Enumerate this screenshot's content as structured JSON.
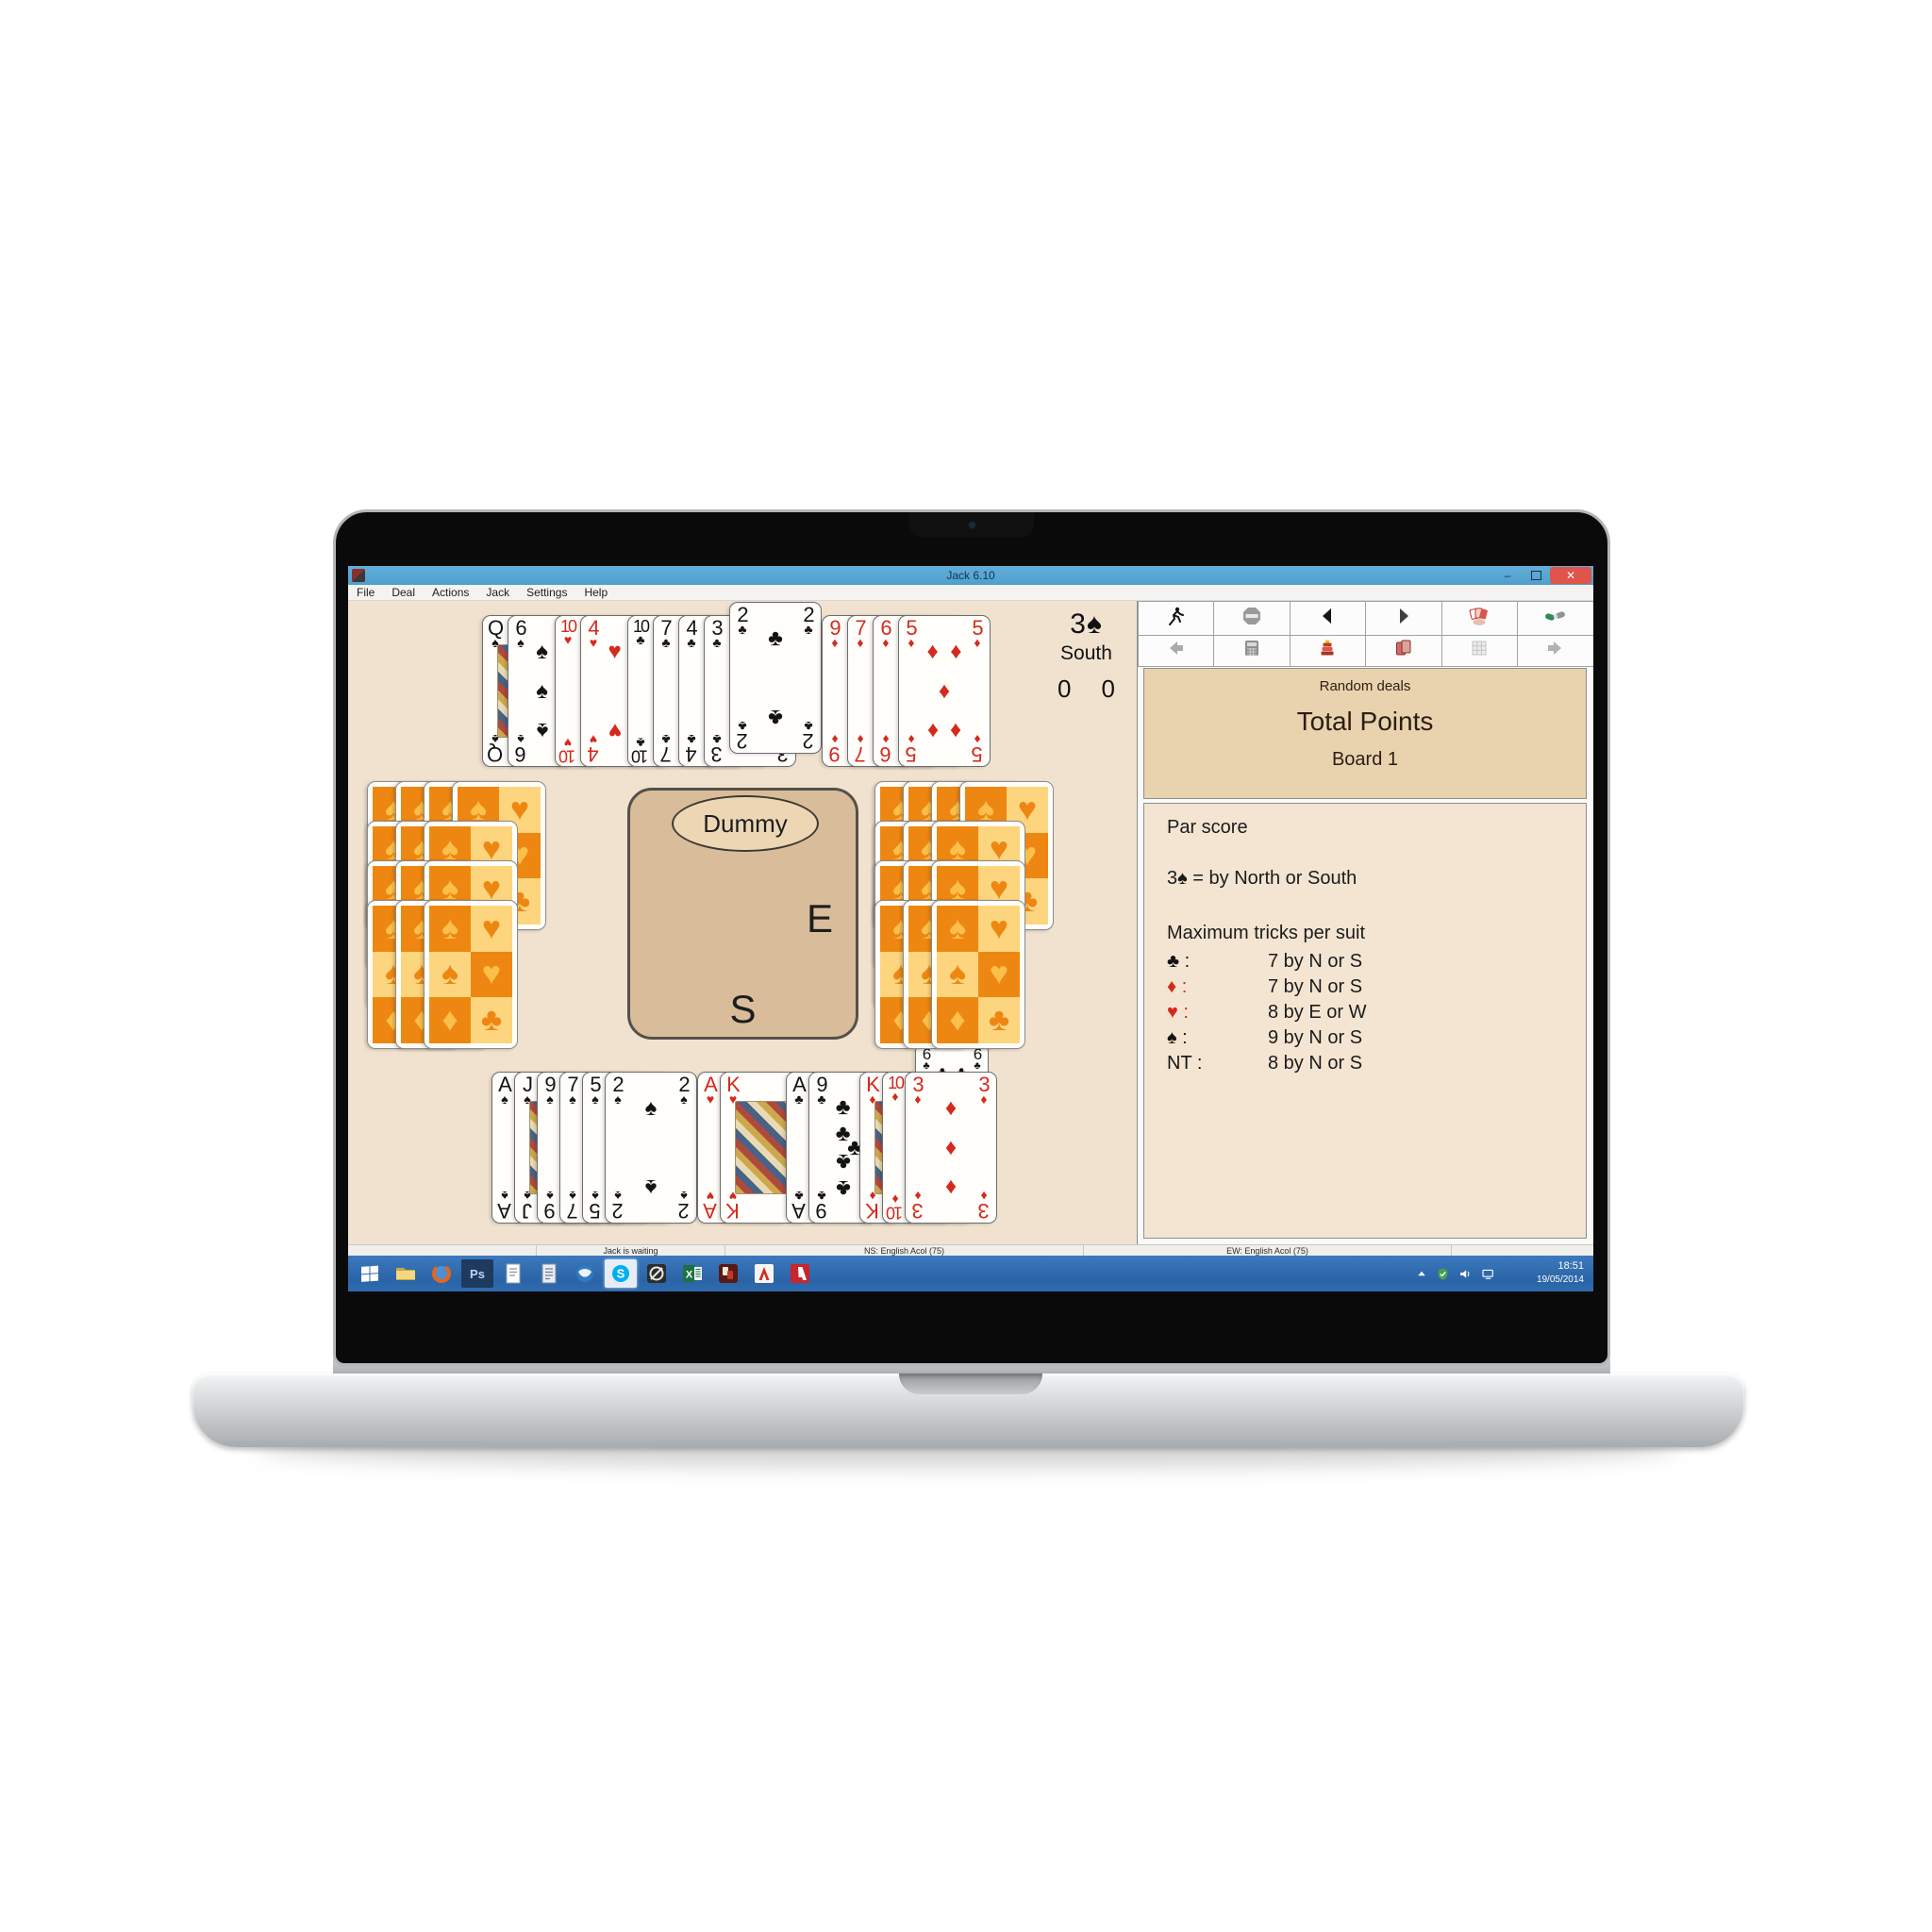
{
  "window": {
    "title": "Jack 6.10",
    "menu": [
      "File",
      "Deal",
      "Actions",
      "Jack",
      "Settings",
      "Help"
    ],
    "controls": {
      "minimize": "–",
      "close": "✕"
    }
  },
  "toolbar": {
    "rows": [
      [
        {
          "name": "play",
          "icon": "runner-icon"
        },
        {
          "name": "stop",
          "icon": "stop-icon"
        },
        {
          "name": "step-back",
          "icon": "triangle-left-icon"
        },
        {
          "name": "step-forward",
          "icon": "triangle-right-icon"
        },
        {
          "name": "show-hand",
          "icon": "hand-cards-icon"
        },
        {
          "name": "claim",
          "icon": "handshake-icon"
        }
      ],
      [
        {
          "name": "previous",
          "icon": "arrow-left-icon"
        },
        {
          "name": "score",
          "icon": "calculator-icon"
        },
        {
          "name": "bidding",
          "icon": "bid-stack-icon"
        },
        {
          "name": "replay",
          "icon": "cards-icon"
        },
        {
          "name": "grid",
          "icon": "grid-icon"
        },
        {
          "name": "next",
          "icon": "arrow-right-icon"
        }
      ]
    ]
  },
  "contract": {
    "label": "3♠",
    "declarer": "South",
    "tricks_ns": "0",
    "tricks_ew": "0"
  },
  "right_panel": {
    "deal_mode": "Random deals",
    "scoring_title": "Total Points",
    "board_label": "Board 1",
    "par_title": "Par score",
    "par_contract": "3♠ = by North or South",
    "max_tricks_title": "Maximum tricks per suit",
    "max_tricks": [
      {
        "suit": "♣",
        "color": "#141414",
        "value": "7 by N or S"
      },
      {
        "suit": "♦",
        "color": "#d42a1e",
        "value": "7 by N or S"
      },
      {
        "suit": "♥",
        "color": "#d42a1e",
        "value": "8 by E or W"
      },
      {
        "suit": "♠",
        "color": "#141414",
        "value": "9 by N or S"
      },
      {
        "suit": "NT",
        "color": "#141414",
        "value": "8 by N or S"
      }
    ]
  },
  "table": {
    "dummy_label": "Dummy",
    "east_label": "E",
    "south_label": "S",
    "played_card": {
      "rank": "6",
      "suit": "C"
    }
  },
  "hands": {
    "north": [
      {
        "rank": "Q",
        "suit": "S"
      },
      {
        "rank": "6",
        "suit": "S"
      },
      {
        "rank": "10",
        "suit": "H"
      },
      {
        "rank": "4",
        "suit": "H"
      },
      {
        "rank": "10",
        "suit": "C"
      },
      {
        "rank": "7",
        "suit": "C"
      },
      {
        "rank": "4",
        "suit": "C"
      },
      {
        "rank": "3",
        "suit": "C"
      },
      {
        "rank": "2",
        "suit": "C",
        "raised": true
      },
      {
        "rank": "9",
        "suit": "D"
      },
      {
        "rank": "7",
        "suit": "D"
      },
      {
        "rank": "6",
        "suit": "D"
      },
      {
        "rank": "5",
        "suit": "D"
      }
    ],
    "south": [
      {
        "rank": "A",
        "suit": "S"
      },
      {
        "rank": "J",
        "suit": "S"
      },
      {
        "rank": "9",
        "suit": "S"
      },
      {
        "rank": "7",
        "suit": "S"
      },
      {
        "rank": "5",
        "suit": "S"
      },
      {
        "rank": "2",
        "suit": "S"
      },
      {
        "rank": "A",
        "suit": "H"
      },
      {
        "rank": "K",
        "suit": "H"
      },
      {
        "rank": "A",
        "suit": "C"
      },
      {
        "rank": "9",
        "suit": "C"
      },
      {
        "rank": "K",
        "suit": "D"
      },
      {
        "rank": "10",
        "suit": "D"
      },
      {
        "rank": "3",
        "suit": "D"
      }
    ],
    "west_facedown_rows": [
      4,
      3,
      3,
      3
    ],
    "east_facedown_rows": [
      4,
      3,
      3,
      3
    ]
  },
  "status_bar": {
    "left": "Jack is waiting",
    "ns": "NS: English Acol (75)",
    "ew": "EW: English Acol (75)"
  },
  "taskbar": {
    "icons": [
      {
        "name": "explorer-icon"
      },
      {
        "name": "firefox-icon"
      },
      {
        "name": "photoshop-icon",
        "label": "Ps",
        "bg": "#1f3a5f",
        "fg": "#bcd6f2"
      },
      {
        "name": "notepad-icon"
      },
      {
        "name": "wordpad-icon"
      },
      {
        "name": "thunderbird-icon"
      },
      {
        "name": "skype-icon",
        "active": true
      },
      {
        "name": "game-icon"
      },
      {
        "name": "excel-icon"
      },
      {
        "name": "jack-app-icon"
      },
      {
        "name": "acrobat-icon"
      },
      {
        "name": "adobe-icon"
      }
    ],
    "tray": {
      "time": "18:51",
      "date": "19/05/2014"
    }
  },
  "colors": {
    "titlebar_blue": "#58a7d6",
    "taskbar_blue": "#2e6eb4",
    "felt_beige": "#f1e2d0",
    "table_tan": "#d9bd9b",
    "panel_tan": "#e9d2ae",
    "card_back_orange": "#ee8711",
    "suit_red": "#d42a1e",
    "suit_black": "#141414",
    "close_red": "#df544b"
  }
}
